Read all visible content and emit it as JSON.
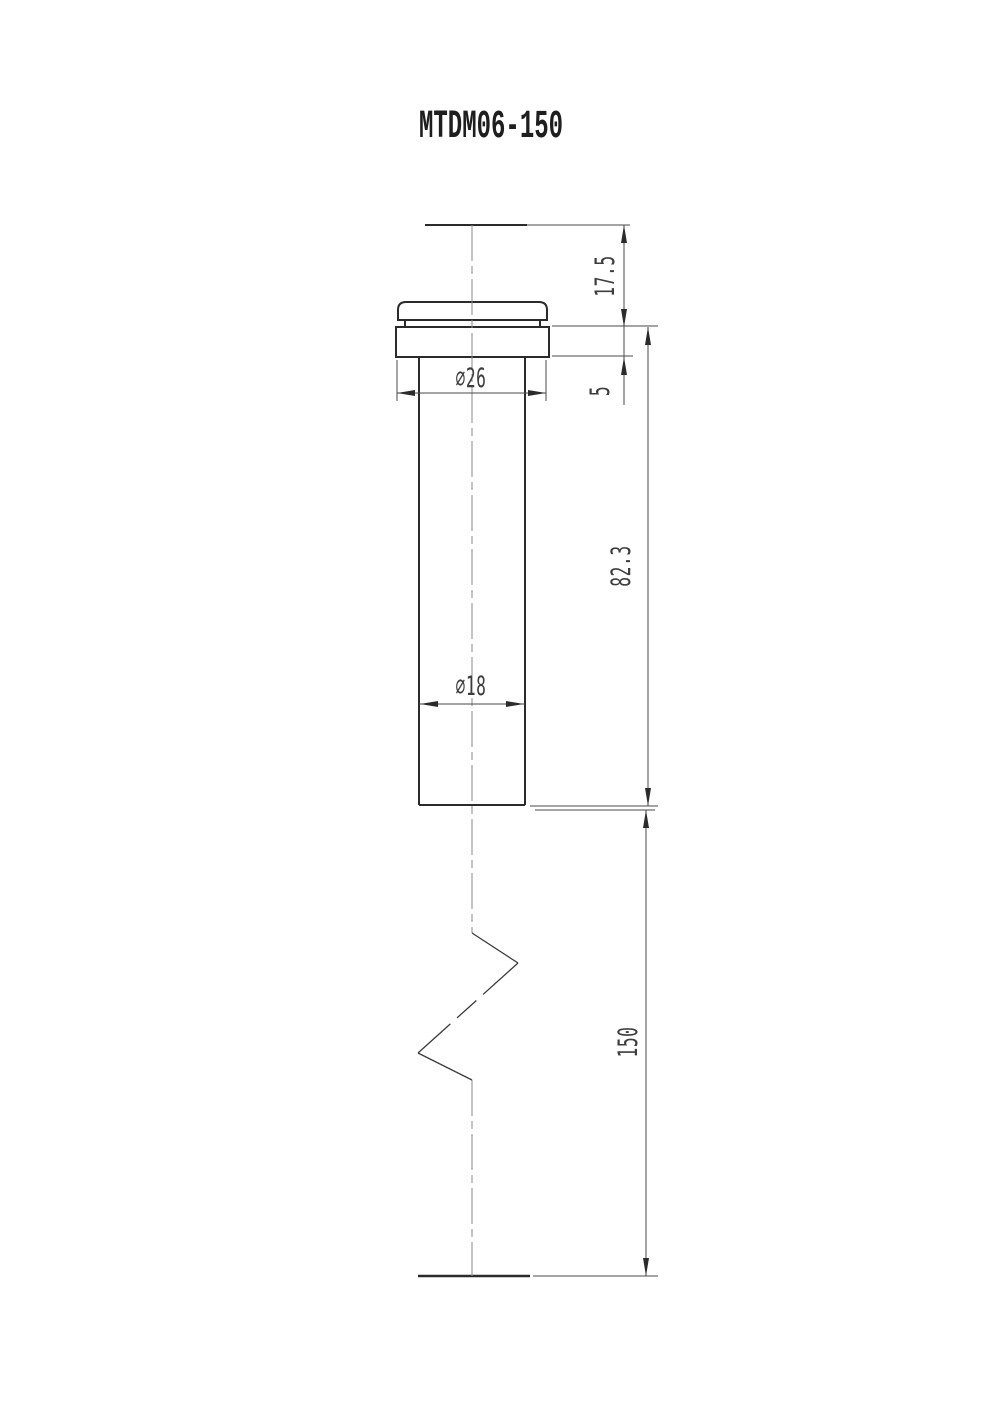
{
  "title": "MTDM06-150",
  "drawing": {
    "part_name": "MTDM06-150",
    "dim_top_height": "17.5",
    "dim_flange_thickness": "5",
    "dim_body_length": "82.3",
    "dim_overall_length": "150",
    "dim_flange_diameter": "∅26",
    "dim_body_diameter": "∅18"
  }
}
